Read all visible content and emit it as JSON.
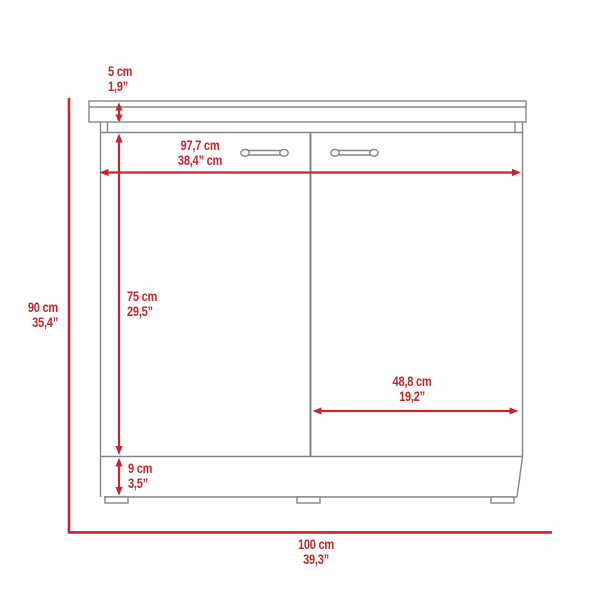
{
  "title": "Cabinet dimension diagram",
  "colors": {
    "dimension_red": "#c4262d",
    "outline_gray": "#858585"
  },
  "dimensions": {
    "countertop_thickness": {
      "cm": "5 cm",
      "in": "1,9”"
    },
    "inner_width": {
      "cm": "97,7 cm",
      "in": "38,4” cm"
    },
    "overall_height": {
      "cm": "90 cm",
      "in": "35,4”"
    },
    "door_height": {
      "cm": "75 cm",
      "in": "29,5”"
    },
    "door_width": {
      "cm": "48,8 cm",
      "in": "19,2”"
    },
    "base_height": {
      "cm": "9 cm",
      "in": "3,5”"
    },
    "overall_width": {
      "cm": "100 cm",
      "in": "39,3”"
    }
  }
}
